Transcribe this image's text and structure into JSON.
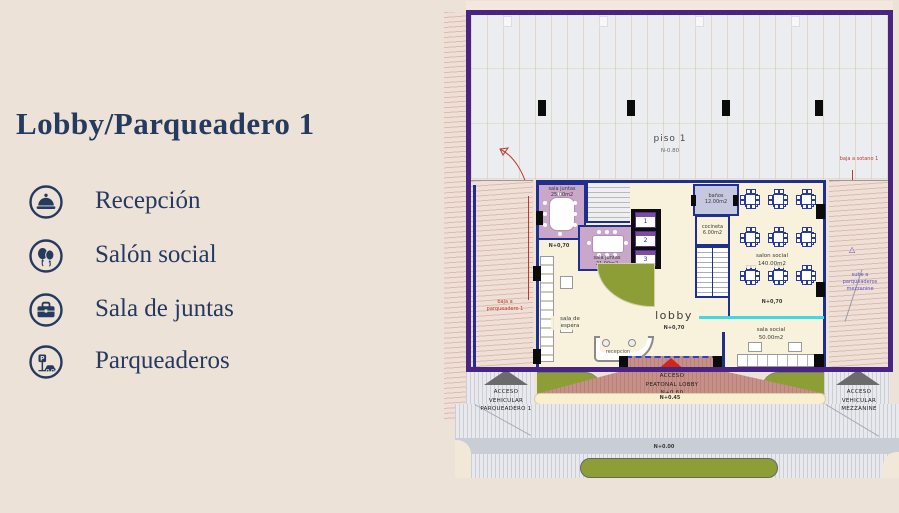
{
  "colors": {
    "background": "#EDE2D8",
    "navy_text": "#243A5E",
    "plan_border_purple": "#4A2483",
    "wall_navy": "#1E2F8F",
    "room_mauve": "#C9A7CB",
    "banos_lavender": "#C6C8DF",
    "floor_cream": "#F8F2DC",
    "grass_olive": "#8C9E35",
    "walkway_pink": "#C69089",
    "street_gray": "#E7E9EC",
    "accent_red": "#C0392B",
    "glass_cyan": "#3FD9E3"
  },
  "left_panel": {
    "title": "Lobby/Parqueadero 1",
    "features": [
      {
        "icon": "reception-bell-icon",
        "label": "Recepción"
      },
      {
        "icon": "balloons-icon",
        "label": "Salón social"
      },
      {
        "icon": "briefcase-icon",
        "label": "Sala de juntas"
      },
      {
        "icon": "parking-sign-icon",
        "label": "Parqueaderos"
      }
    ]
  },
  "plan": {
    "parking": {
      "name": "piso 1",
      "level": "N-0.80"
    },
    "annotations": {
      "baja_sotano": "baja a sotano 1",
      "baja_parqueadero": "baja a parqueadero 1",
      "sube_mezzanine": "sube a parqueaderos mezzanine"
    },
    "rooms": {
      "sala_juntas_25": {
        "name": "sala juntas",
        "area": "25.00m2"
      },
      "sala_juntas_21": {
        "name": "sala juntas",
        "area": "21.00m2"
      },
      "banos": {
        "name": "baños",
        "area": "12.00m2"
      },
      "cocineta": {
        "name": "cocineta",
        "area": "6.00m2"
      },
      "salon_social": {
        "name": "salon social",
        "area": "140.00m2",
        "level": "N+0,70"
      },
      "sala_social": {
        "name": "sala social",
        "area": "50.00m2"
      },
      "sala_espera": {
        "name": "sala de espera"
      },
      "lobby": {
        "name": "lobby",
        "level": "N+0,70"
      },
      "recepcion": {
        "name": "recepcion"
      },
      "hall_level": "N+0,70"
    },
    "elevators": {
      "e1": "1",
      "e2": "2",
      "e3": "3"
    },
    "access": {
      "vehicular_parqueadero": {
        "l1": "ACCESO",
        "l2": "VEHICULAR",
        "l3": "PARQUEADERO 1"
      },
      "peatonal": {
        "l1": "ACCESO",
        "l2": "PEATONAL LOBBY",
        "level": "N+0.60"
      },
      "vehicular_mezzanine": {
        "l1": "ACCESO",
        "l2": "VEHICULAR",
        "l3": "MEZZANINE"
      }
    },
    "levels": {
      "sidewalk": "N+0.45",
      "street": "N+0.00"
    }
  }
}
